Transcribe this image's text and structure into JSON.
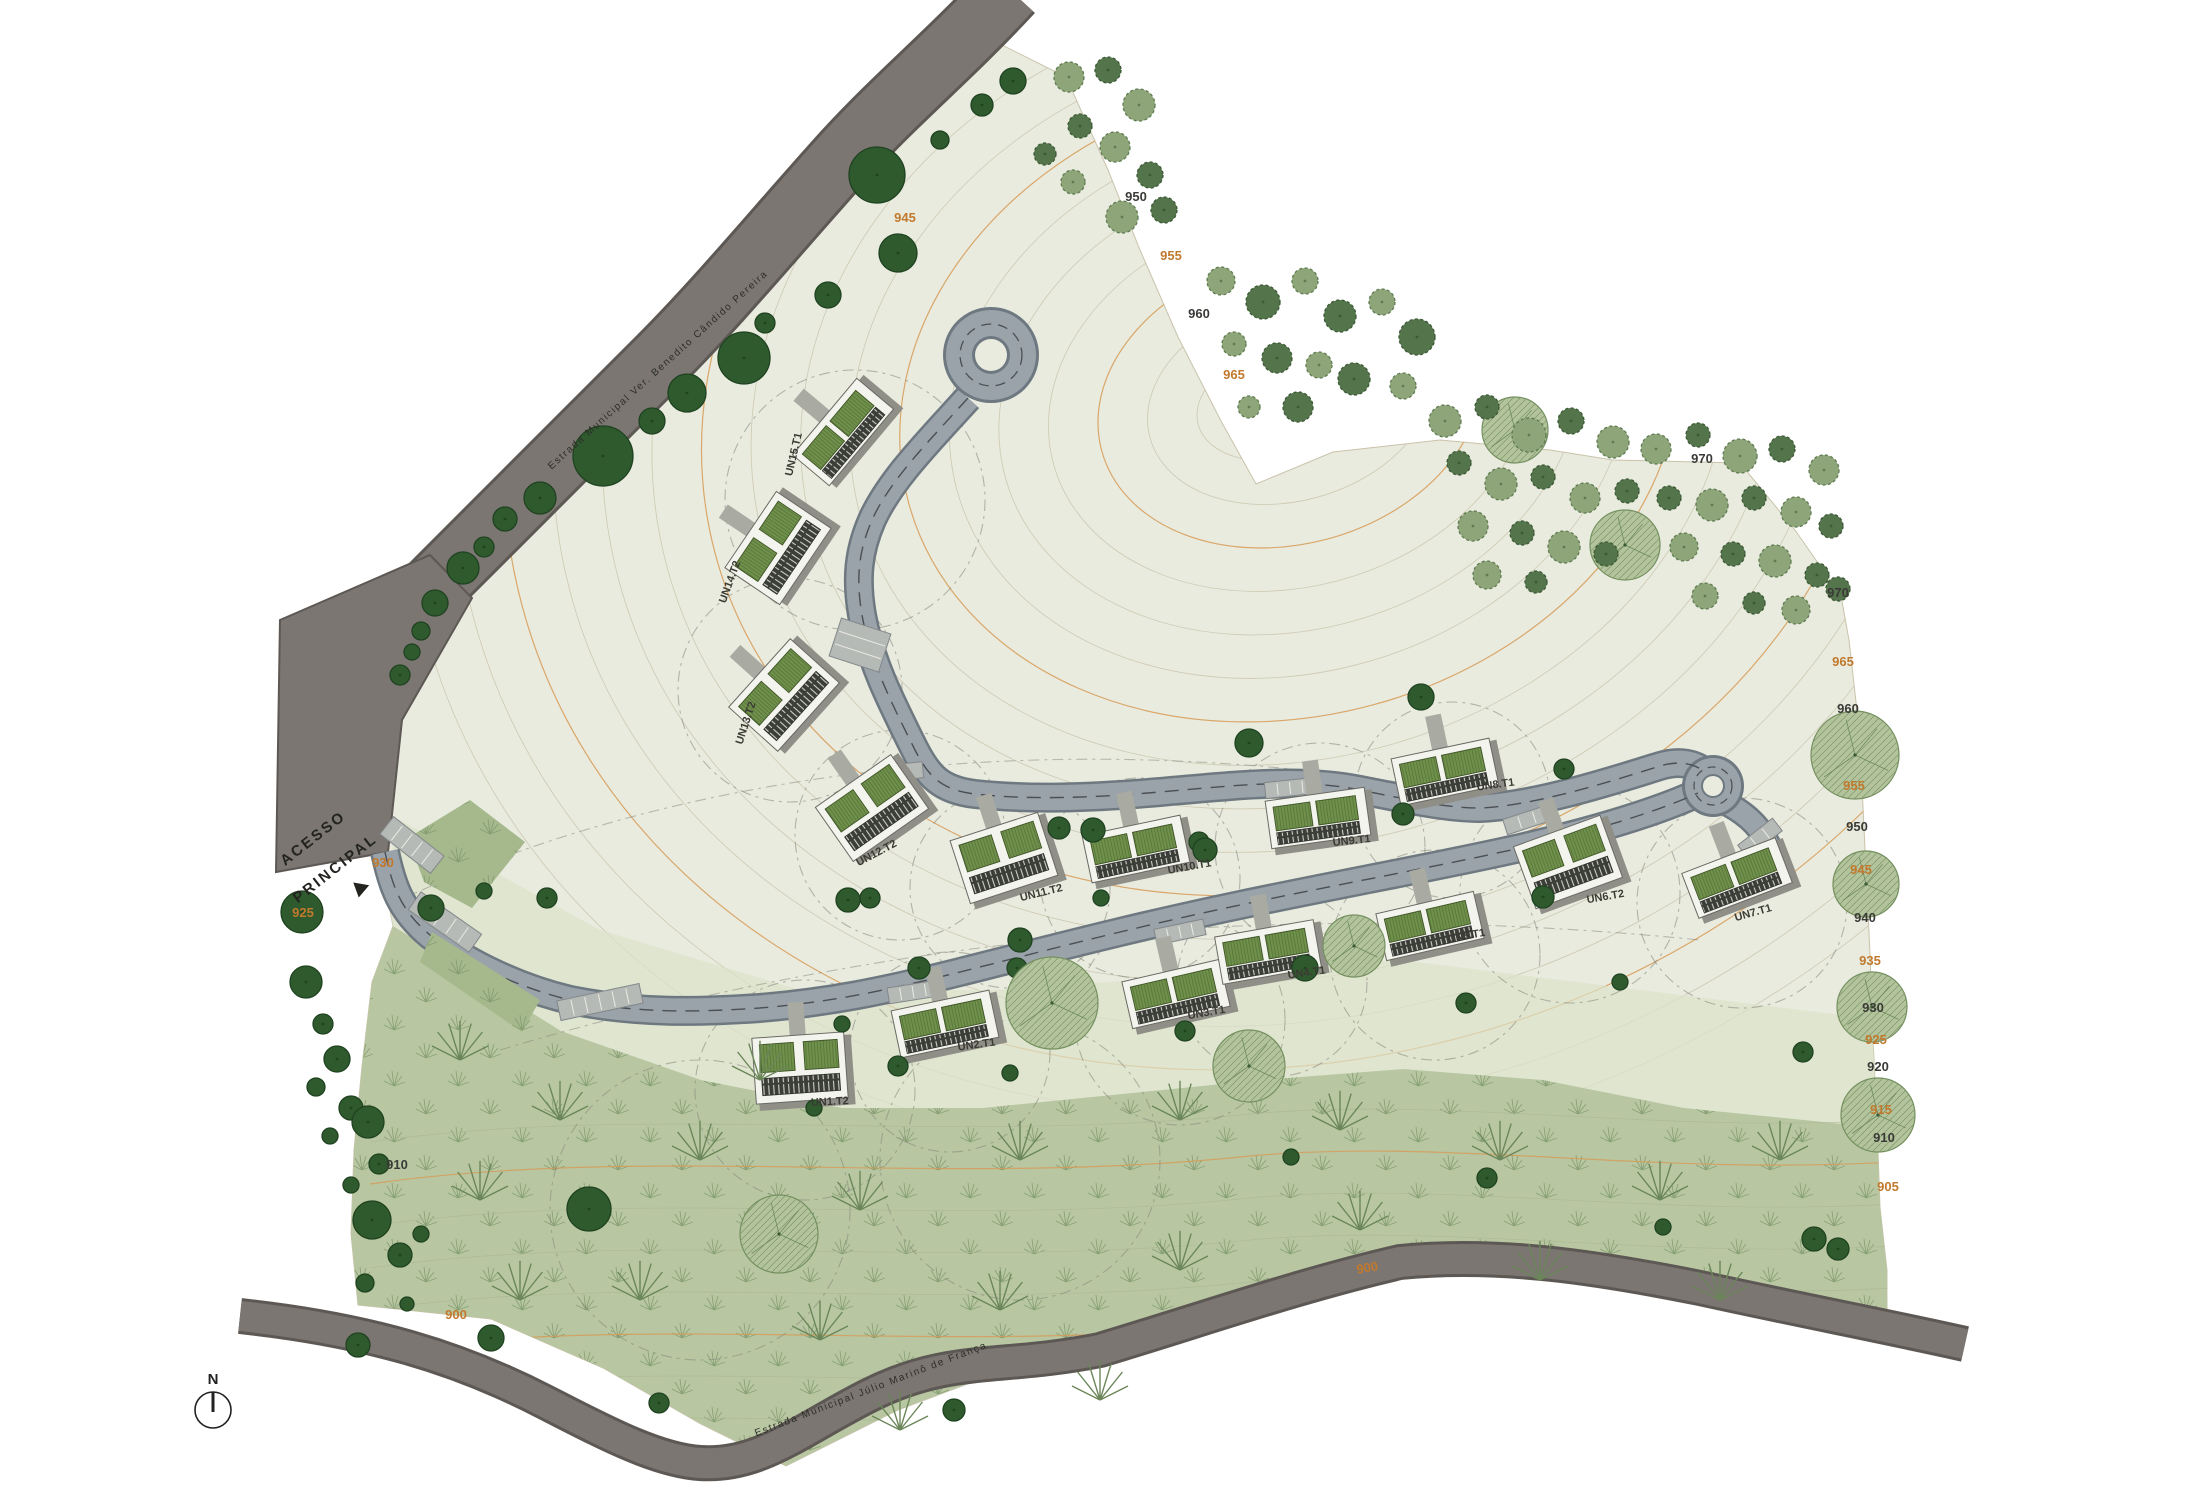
{
  "labels": {
    "access_line1": "ACESSO",
    "access_line2": "PRINCIPAL",
    "north": "N",
    "road_top": "Estrada Municipal Ver. Benedito Cândido Pereira",
    "road_bottom": "Estrada Municipal Júlio Marinô de França",
    "road_level_bottom": "900"
  },
  "colors": {
    "terrain": "#e9ebdf",
    "terrain_mid": "#dbe2c9",
    "forest": "#b8c7a2",
    "road_major": "#7b7672",
    "road_major_edge": "#5d5854",
    "road_minor": "#9aa3aa",
    "road_minor_edge": "#6e7880",
    "contour": "#c9c3aa",
    "contour_index": "#d79a55",
    "tree_dark": "#2f5a2e",
    "tree_mid": "#8ea579",
    "tree_deep": "#54744b",
    "tree_pale": "#b3c49c",
    "roof": "#70904c",
    "deck": "#3a3d38",
    "slab": "#f4f4ef",
    "elev_orange": "#c1792d",
    "elev_black": "#3a3a36",
    "parking": "#b6bab6"
  },
  "buildings": [
    [
      "UN15.T1",
      843,
      432,
      -50,
      "T1",
      797,
      455,
      -77
    ],
    [
      "UN14.T2",
      778,
      548,
      -56,
      "T2",
      733,
      583,
      -70
    ],
    [
      "UN13.T2",
      784,
      695,
      -48,
      "T2",
      749,
      724,
      -72
    ],
    [
      "UN12.T2",
      872,
      808,
      -35,
      "T2",
      878,
      856,
      -28
    ],
    [
      "UN11.T2",
      1004,
      858,
      -18,
      "T2",
      1042,
      896,
      -14
    ],
    [
      "UN10.T1",
      1136,
      849,
      -12,
      "T1",
      1190,
      870,
      -10
    ],
    [
      "UN9.T1",
      1318,
      818,
      -8,
      "T1",
      1352,
      844,
      -6
    ],
    [
      "UN8.T1",
      1445,
      772,
      -12,
      "T1",
      1496,
      788,
      -8
    ],
    [
      "UN6.T2",
      1568,
      862,
      -20,
      "T2",
      1606,
      900,
      -10
    ],
    [
      "UN7.T1",
      1737,
      878,
      -21,
      "T1",
      1754,
      916,
      -16
    ],
    [
      "UN1.T2",
      800,
      1068,
      -4,
      "T2",
      830,
      1105,
      -3
    ],
    [
      "UN2.T1",
      945,
      1024,
      -12,
      "T1",
      977,
      1048,
      -8
    ],
    [
      "UN3.T1",
      1176,
      994,
      -13,
      "T1",
      1207,
      1016,
      -10
    ],
    [
      "UN4.T1",
      1268,
      952,
      -10,
      "T1",
      1307,
      976,
      -8
    ],
    [
      "UN5.T1",
      1430,
      926,
      -13,
      "T1",
      1467,
      939,
      -10
    ]
  ],
  "elevations": [
    [
      "945",
      905,
      222,
      "o"
    ],
    [
      "950",
      1136,
      201,
      "k"
    ],
    [
      "955",
      1171,
      260,
      "o"
    ],
    [
      "960",
      1199,
      318,
      "k"
    ],
    [
      "965",
      1234,
      379,
      "o"
    ],
    [
      "970",
      1702,
      463,
      "k"
    ],
    [
      "970",
      1838,
      597,
      "k"
    ],
    [
      "965",
      1843,
      666,
      "o"
    ],
    [
      "960",
      1848,
      713,
      "k"
    ],
    [
      "955",
      1854,
      790,
      "o"
    ],
    [
      "950",
      1857,
      831,
      "k"
    ],
    [
      "945",
      1861,
      874,
      "o"
    ],
    [
      "940",
      1865,
      922,
      "k"
    ],
    [
      "935",
      1870,
      965,
      "o"
    ],
    [
      "930",
      1873,
      1012,
      "k"
    ],
    [
      "925",
      1876,
      1044,
      "o"
    ],
    [
      "920",
      1878,
      1071,
      "k"
    ],
    [
      "915",
      1881,
      1114,
      "o"
    ],
    [
      "910",
      1884,
      1142,
      "k"
    ],
    [
      "905",
      1888,
      1191,
      "o"
    ],
    [
      "930",
      383,
      867,
      "o"
    ],
    [
      "925",
      303,
      917,
      "o"
    ],
    [
      "910",
      397,
      1169,
      "k"
    ],
    [
      "900",
      456,
      1319,
      "o"
    ]
  ],
  "trees": [
    [
      744,
      358,
      26,
      "d"
    ],
    [
      687,
      393,
      19,
      "d"
    ],
    [
      652,
      421,
      13,
      "d"
    ],
    [
      603,
      456,
      30,
      "d"
    ],
    [
      540,
      498,
      16,
      "d"
    ],
    [
      505,
      519,
      12,
      "d"
    ],
    [
      484,
      547,
      10,
      "d"
    ],
    [
      463,
      568,
      16,
      "d"
    ],
    [
      435,
      603,
      13,
      "d"
    ],
    [
      421,
      631,
      9,
      "d"
    ],
    [
      412,
      652,
      8,
      "d"
    ],
    [
      400,
      675,
      10,
      "d"
    ],
    [
      877,
      175,
      28,
      "d"
    ],
    [
      898,
      253,
      19,
      "d"
    ],
    [
      828,
      295,
      13,
      "d"
    ],
    [
      765,
      323,
      10,
      "d"
    ],
    [
      982,
      105,
      11,
      "d"
    ],
    [
      1013,
      81,
      13,
      "d"
    ],
    [
      940,
      140,
      9,
      "d"
    ],
    [
      302,
      912,
      21,
      "d"
    ],
    [
      306,
      982,
      16,
      "d"
    ],
    [
      323,
      1024,
      10,
      "d"
    ],
    [
      337,
      1059,
      13,
      "d"
    ],
    [
      316,
      1087,
      9,
      "d"
    ],
    [
      351,
      1108,
      12,
      "d"
    ],
    [
      330,
      1136,
      8,
      "d"
    ],
    [
      368,
      1122,
      16,
      "d"
    ],
    [
      379,
      1164,
      10,
      "d"
    ],
    [
      351,
      1185,
      8,
      "d"
    ],
    [
      372,
      1220,
      19,
      "d"
    ],
    [
      400,
      1255,
      12,
      "d"
    ],
    [
      421,
      1234,
      8,
      "d"
    ],
    [
      365,
      1283,
      9,
      "d"
    ],
    [
      407,
      1304,
      7,
      "d"
    ],
    [
      358,
      1345,
      12,
      "d"
    ],
    [
      431,
      908,
      13,
      "d"
    ],
    [
      484,
      891,
      8,
      "d"
    ],
    [
      547,
      898,
      10,
      "d"
    ],
    [
      870,
      898,
      10,
      "d"
    ],
    [
      919,
      968,
      11,
      "d"
    ],
    [
      842,
      1024,
      8,
      "d"
    ],
    [
      1017,
      968,
      10,
      "d"
    ],
    [
      1059,
      828,
      11,
      "d"
    ],
    [
      1199,
      842,
      10,
      "d"
    ],
    [
      1101,
      898,
      8,
      "d"
    ],
    [
      1249,
      743,
      14,
      "d"
    ],
    [
      1403,
      814,
      11,
      "d"
    ],
    [
      1564,
      769,
      10,
      "d"
    ],
    [
      1305,
      968,
      13,
      "d"
    ],
    [
      1185,
      1031,
      10,
      "d"
    ],
    [
      1010,
      1073,
      8,
      "d"
    ],
    [
      898,
      1066,
      10,
      "d"
    ],
    [
      814,
      1108,
      8,
      "d"
    ],
    [
      1270,
      1059,
      11,
      "d"
    ],
    [
      1466,
      1003,
      10,
      "d"
    ],
    [
      1620,
      982,
      8,
      "d"
    ],
    [
      1803,
      1052,
      10,
      "d"
    ],
    [
      1291,
      1157,
      8,
      "d"
    ],
    [
      1487,
      1178,
      10,
      "d"
    ],
    [
      1663,
      1227,
      8,
      "d"
    ],
    [
      1838,
      1249,
      11,
      "d"
    ],
    [
      589,
      1209,
      22,
      "d"
    ],
    [
      1421,
      697,
      13,
      "d"
    ],
    [
      1543,
      897,
      11,
      "d"
    ],
    [
      1205,
      850,
      12,
      "d"
    ],
    [
      1093,
      830,
      12,
      "d"
    ],
    [
      848,
      900,
      12,
      "d"
    ],
    [
      1020,
      940,
      12,
      "d"
    ],
    [
      659,
      1403,
      10,
      "d"
    ],
    [
      954,
      1410,
      11,
      "d"
    ],
    [
      1814,
      1239,
      12,
      "d"
    ],
    [
      491,
      1338,
      13,
      "d"
    ],
    [
      1052,
      1003,
      46,
      "p"
    ],
    [
      1249,
      1066,
      36,
      "p"
    ],
    [
      1354,
      946,
      31,
      "p"
    ],
    [
      779,
      1234,
      39,
      "p"
    ],
    [
      1855,
      755,
      44,
      "p"
    ],
    [
      1866,
      884,
      33,
      "p"
    ],
    [
      1872,
      1007,
      35,
      "p"
    ],
    [
      1878,
      1115,
      37,
      "p"
    ],
    [
      1515,
      430,
      33,
      "p"
    ],
    [
      1625,
      545,
      35,
      "p"
    ],
    [
      1069,
      77,
      15,
      "m"
    ],
    [
      1108,
      70,
      13,
      "c"
    ],
    [
      1139,
      105,
      16,
      "m"
    ],
    [
      1080,
      126,
      12,
      "c"
    ],
    [
      1115,
      147,
      15,
      "m"
    ],
    [
      1150,
      175,
      13,
      "c"
    ],
    [
      1073,
      182,
      12,
      "m"
    ],
    [
      1045,
      154,
      11,
      "c"
    ],
    [
      1122,
      217,
      16,
      "m"
    ],
    [
      1164,
      210,
      13,
      "c"
    ],
    [
      1221,
      281,
      14,
      "m"
    ],
    [
      1263,
      302,
      17,
      "c"
    ],
    [
      1305,
      281,
      13,
      "m"
    ],
    [
      1340,
      316,
      16,
      "c"
    ],
    [
      1382,
      302,
      13,
      "m"
    ],
    [
      1417,
      337,
      18,
      "c"
    ],
    [
      1234,
      344,
      12,
      "m"
    ],
    [
      1277,
      358,
      15,
      "c"
    ],
    [
      1319,
      365,
      13,
      "m"
    ],
    [
      1354,
      379,
      16,
      "c"
    ],
    [
      1403,
      386,
      13,
      "m"
    ],
    [
      1298,
      407,
      15,
      "c"
    ],
    [
      1249,
      407,
      11,
      "m"
    ],
    [
      1445,
      421,
      16,
      "m"
    ],
    [
      1487,
      407,
      12,
      "c"
    ],
    [
      1529,
      435,
      17,
      "m"
    ],
    [
      1571,
      421,
      13,
      "c"
    ],
    [
      1613,
      442,
      16,
      "m"
    ],
    [
      1459,
      463,
      12,
      "c"
    ],
    [
      1501,
      484,
      16,
      "m"
    ],
    [
      1543,
      477,
      12,
      "c"
    ],
    [
      1585,
      498,
      15,
      "m"
    ],
    [
      1627,
      491,
      12,
      "c"
    ],
    [
      1473,
      526,
      15,
      "m"
    ],
    [
      1522,
      533,
      12,
      "c"
    ],
    [
      1564,
      547,
      16,
      "m"
    ],
    [
      1606,
      554,
      12,
      "c"
    ],
    [
      1487,
      575,
      14,
      "m"
    ],
    [
      1536,
      582,
      11,
      "c"
    ],
    [
      1656,
      449,
      15,
      "m"
    ],
    [
      1698,
      435,
      12,
      "c"
    ],
    [
      1740,
      456,
      17,
      "m"
    ],
    [
      1782,
      449,
      13,
      "c"
    ],
    [
      1824,
      470,
      15,
      "m"
    ],
    [
      1669,
      498,
      12,
      "c"
    ],
    [
      1712,
      505,
      16,
      "m"
    ],
    [
      1754,
      498,
      12,
      "c"
    ],
    [
      1796,
      512,
      15,
      "m"
    ],
    [
      1831,
      526,
      12,
      "c"
    ],
    [
      1684,
      547,
      14,
      "m"
    ],
    [
      1733,
      554,
      12,
      "c"
    ],
    [
      1775,
      561,
      16,
      "m"
    ],
    [
      1817,
      575,
      12,
      "c"
    ],
    [
      1705,
      596,
      13,
      "m"
    ],
    [
      1754,
      603,
      11,
      "c"
    ],
    [
      1796,
      610,
      14,
      "m"
    ],
    [
      1838,
      589,
      12,
      "c"
    ],
    [
      560,
      1120,
      0,
      "f"
    ],
    [
      700,
      1160,
      0,
      "f"
    ],
    [
      860,
      1210,
      0,
      "f"
    ],
    [
      1020,
      1160,
      0,
      "f"
    ],
    [
      1180,
      1120,
      0,
      "f"
    ],
    [
      1340,
      1130,
      0,
      "f"
    ],
    [
      1500,
      1160,
      0,
      "f"
    ],
    [
      1660,
      1200,
      0,
      "f"
    ],
    [
      1780,
      1160,
      0,
      "f"
    ],
    [
      640,
      1300,
      0,
      "f"
    ],
    [
      820,
      1340,
      0,
      "f"
    ],
    [
      1000,
      1310,
      0,
      "f"
    ],
    [
      1180,
      1270,
      0,
      "f"
    ],
    [
      1360,
      1230,
      0,
      "f"
    ],
    [
      1540,
      1280,
      0,
      "f"
    ],
    [
      1720,
      1300,
      0,
      "f"
    ],
    [
      480,
      1200,
      0,
      "f"
    ],
    [
      520,
      1300,
      0,
      "f"
    ],
    [
      900,
      1430,
      0,
      "f"
    ],
    [
      1100,
      1400,
      0,
      "f"
    ],
    [
      760,
      1080,
      0,
      "f"
    ],
    [
      460,
      1060,
      0,
      "f"
    ]
  ]
}
